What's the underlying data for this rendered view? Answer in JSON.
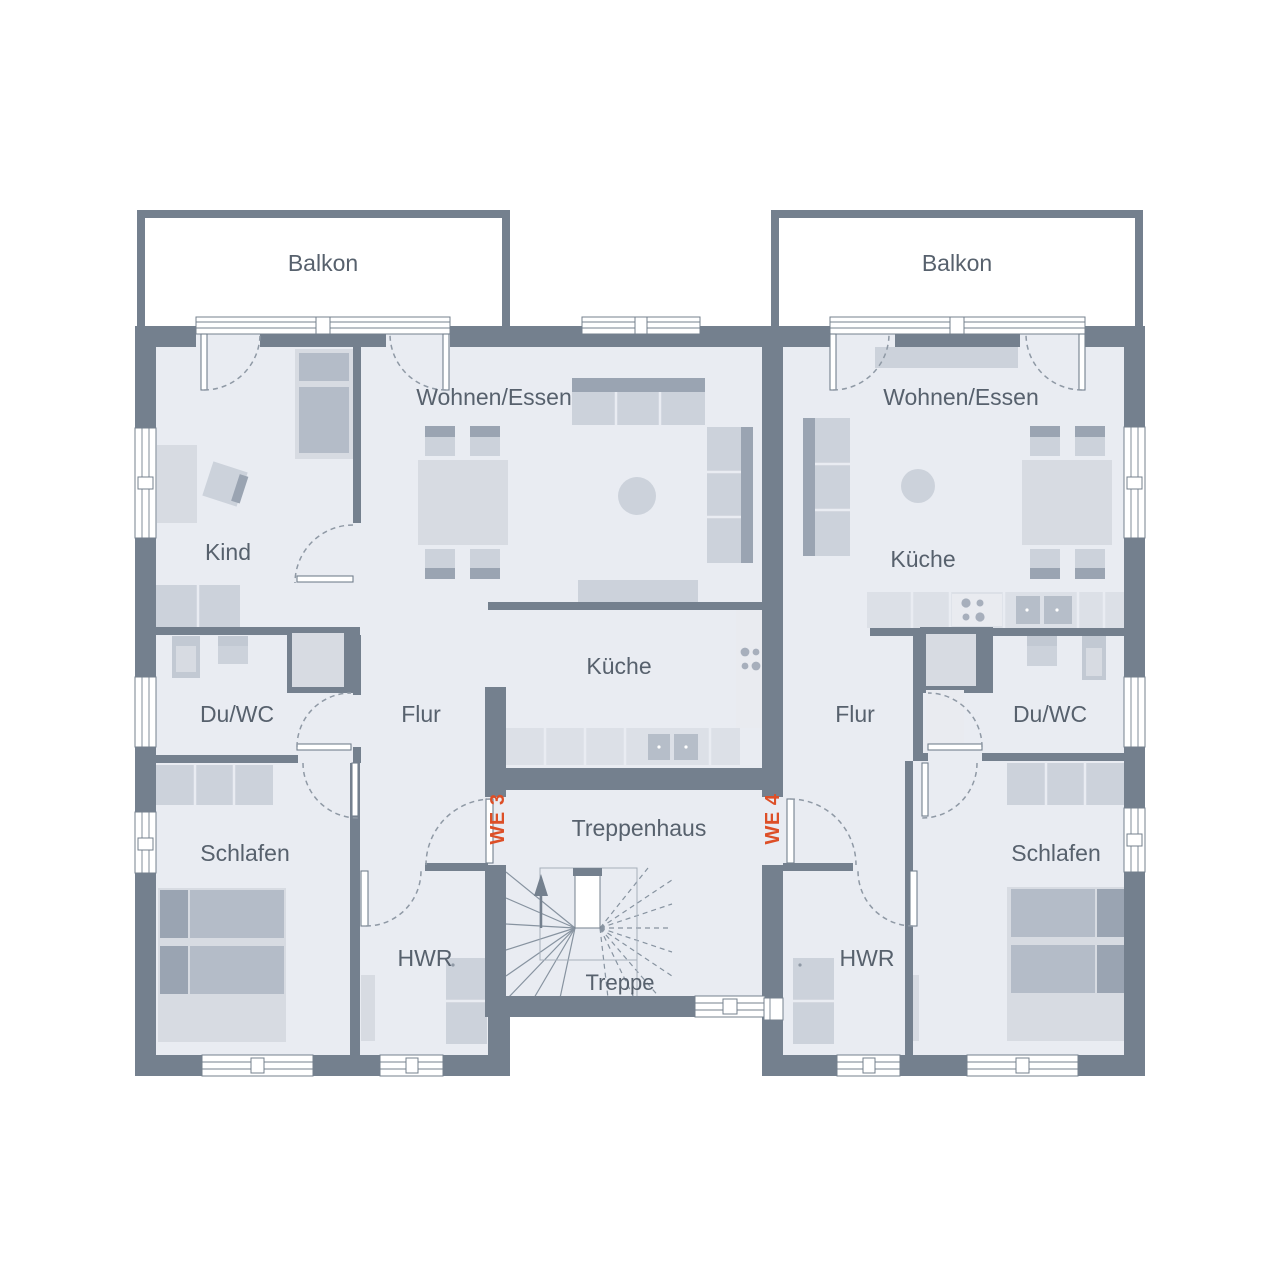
{
  "plan": {
    "type": "floor-plan",
    "units": [
      {
        "id": "WE 3",
        "rooms": [
          "Balkon",
          "Wohnen/Essen",
          "Kind",
          "Küche",
          "Du/WC",
          "Flur",
          "Schlafen",
          "HWR"
        ]
      },
      {
        "id": "WE 4",
        "rooms": [
          "Balkon",
          "Wohnen/Essen",
          "Küche",
          "Du/WC",
          "Flur",
          "Schlafen",
          "HWR"
        ]
      }
    ],
    "shared_rooms": [
      "Treppenhaus",
      "Treppe"
    ]
  },
  "labels": {
    "balkon_left": "Balkon",
    "balkon_right": "Balkon",
    "wohnen_essen_left": "Wohnen/Essen",
    "wohnen_essen_right": "Wohnen/Essen",
    "kind": "Kind",
    "kueche_left": "Küche",
    "kueche_right": "Küche",
    "du_wc_left": "Du/WC",
    "du_wc_right": "Du/WC",
    "flur_left": "Flur",
    "flur_right": "Flur",
    "schlafen_left": "Schlafen",
    "schlafen_right": "Schlafen",
    "hwr_left": "HWR",
    "hwr_right": "HWR",
    "treppenhaus": "Treppenhaus",
    "treppe": "Treppe",
    "we3": "WE 3",
    "we4": "WE 4"
  },
  "colors": {
    "wall": "#74808e",
    "floor": "#e9ecf2",
    "balcony": "#ffffff",
    "furniture_light": "#d7dbe2",
    "furniture_medium": "#c2c9d3",
    "furniture_dark": "#9aa4b2",
    "accent": "#dd4f27",
    "label_text": "#57616d"
  }
}
